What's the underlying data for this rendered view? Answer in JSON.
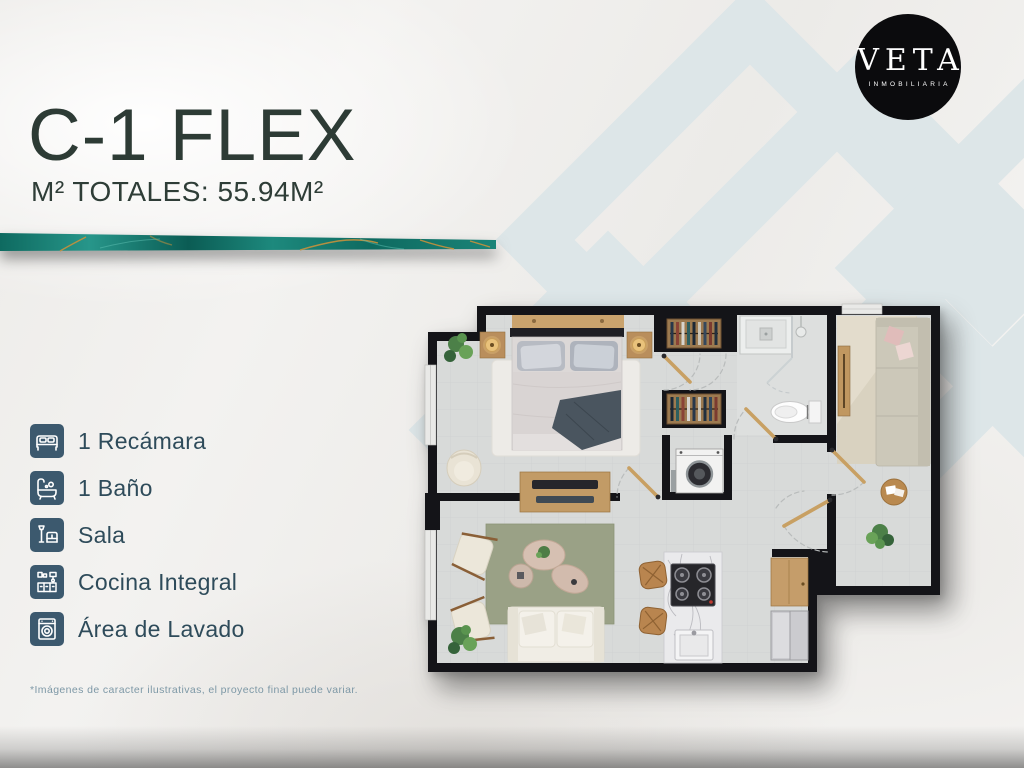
{
  "header": {
    "title": "C-1 FLEX",
    "subtitle": "M² TOTALES: 55.94M²",
    "title_color": "#2d3b35"
  },
  "brand": {
    "logo_text": "VETA",
    "logo_subtext": "INMOBILIARIA",
    "logo_bg": "#0b0b0d",
    "logo_text_color": "#ffffff"
  },
  "accent_strip": {
    "style": "teal-marble-with-gold-veins",
    "teal": "#0f6f65",
    "gold": "#c7913c"
  },
  "features": {
    "icon_bg": "#3c596e",
    "text_color": "#2e4b5a",
    "items": [
      {
        "icon": "bed-icon",
        "label": "1 Recámara"
      },
      {
        "icon": "bath-icon",
        "label": "1 Baño"
      },
      {
        "icon": "sofa-icon",
        "label": "Sala"
      },
      {
        "icon": "kitchen-icon",
        "label": "Cocina Integral"
      },
      {
        "icon": "washer-icon",
        "label": "Área de Lavado"
      }
    ]
  },
  "footer": {
    "disclaimer": "*Imágenes de caracter ilustrativas, el proyecto final puede variar."
  },
  "floorplan_palette": {
    "walls": "#141418",
    "floor": "#d8dad9",
    "wood": "#c29b66",
    "bedroom_rug": "#edebe7",
    "living_rug": "#9aa186",
    "flex_rug": "#d9d2c0",
    "sofa": "#f0ede5",
    "marble_counter": "#eaeaec",
    "throw_blanket": "#4a555f"
  },
  "watermark": {
    "color": "#dde6e8"
  }
}
